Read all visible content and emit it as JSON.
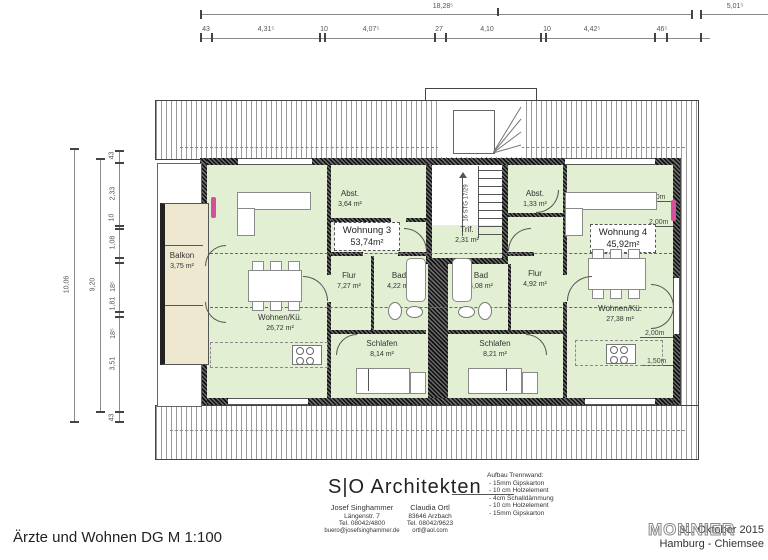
{
  "drawing": {
    "plan_title": "Ärzte und Wohnen DG M 1:100",
    "date": "31. Oktober 2015",
    "location": "Hamburg - Chiemsee",
    "watermark": "MONNIER"
  },
  "firm": {
    "name": "S|O Architekten",
    "partner1": {
      "name": "Josef Singhammer",
      "address": "Längenstr. 7",
      "tel": "Tel. 08042/4800",
      "email": "buero@josefsinghammer.de"
    },
    "partner2": {
      "name": "Claudia Ortl",
      "address": "83646 Arzbach",
      "tel": "Tel. 08042/9623",
      "email": "ortl@aol.com"
    },
    "wall_note": {
      "title": "Aufbau Trennwand:",
      "items": [
        "- 15mm Gipskarton",
        "- 10 cm Holzelement",
        "- 4cm Schalldämmung",
        "- 10 cm Holzelement",
        "- 15mm Gipskarton"
      ]
    }
  },
  "dims": {
    "top_overall": "18,28⁵",
    "top_right": "5,01⁵",
    "top_segments": [
      "43",
      "4,31⁵",
      "10",
      "4,07⁵",
      "27",
      "4,10",
      "10",
      "4,42⁵",
      "46⁵"
    ],
    "left_outer": "10,06",
    "left_inner": "9,20",
    "left_segments": [
      "43",
      "2,33",
      "10",
      "1,08",
      "18⁵",
      "1,81",
      "18⁵",
      "3,51",
      "43"
    ]
  },
  "stair": {
    "label": "16 STG 17/29"
  },
  "levels": {
    "h150": "1,50m",
    "h200": "2,00m"
  },
  "rooms": {
    "balkon": {
      "name": "Balkon",
      "area": "3,75 m²"
    },
    "abst_l": {
      "name": "Abst.",
      "area": "3,64 m²"
    },
    "abst_r": {
      "name": "Abst.",
      "area": "1,33 m²"
    },
    "wohnung3": {
      "name": "Wohnung 3",
      "area": "53,74m²"
    },
    "wohnung4": {
      "name": "Wohnung 4",
      "area": "45,92m²"
    },
    "trif": {
      "name": "Trif.",
      "area": "2,31 m²"
    },
    "flur_l": {
      "name": "Flur",
      "area": "7,27 m²"
    },
    "flur_r": {
      "name": "Flur",
      "area": "4,92 m²"
    },
    "bad_l": {
      "name": "Bad",
      "area": "4,22 m²"
    },
    "bad_r": {
      "name": "Bad",
      "area": "4,08 m²"
    },
    "schlafen_l": {
      "name": "Schlafen",
      "area": "8,14 m²"
    },
    "schlafen_r": {
      "name": "Schlafen",
      "area": "8,21 m²"
    },
    "wohnen_l": {
      "name": "Wohnen/Kü.",
      "area": "26,72 m²"
    },
    "wohnen_r": {
      "name": "Wohnen/Kü.",
      "area": "27,38 m²"
    }
  }
}
